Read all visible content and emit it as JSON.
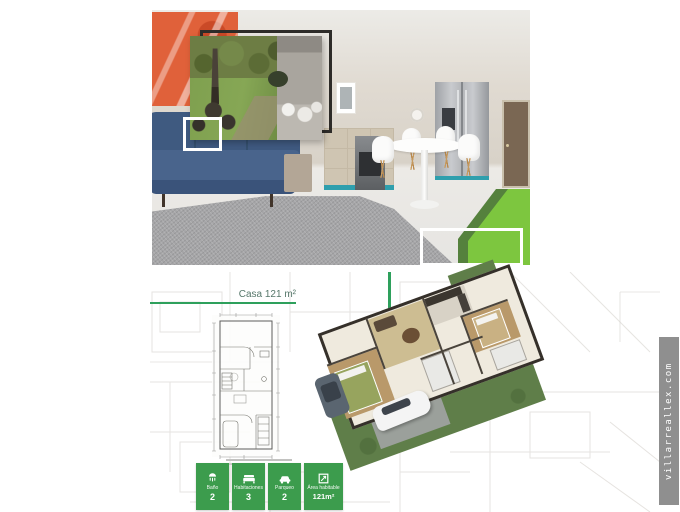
{
  "watermark": {
    "text": "villarreallex.com",
    "bg_color": "#8f8f8f",
    "text_color": "#ffffff"
  },
  "colors": {
    "accent_green": "#3c9c4d",
    "line_green": "#2ea05c",
    "lime_green_block": "#7dc63f",
    "title_green": "#56776a"
  },
  "plan_section": {
    "title": "Casa 121 m²",
    "badges": [
      {
        "icon": "shower-icon",
        "label": "Baño",
        "value": "2"
      },
      {
        "icon": "bed-icon",
        "label": "Habitaciones",
        "value": "3"
      },
      {
        "icon": "car-icon",
        "label": "Parqueo",
        "value": "2"
      },
      {
        "icon": "area-icon",
        "label": "Área habitable",
        "value": "121m²"
      }
    ]
  }
}
